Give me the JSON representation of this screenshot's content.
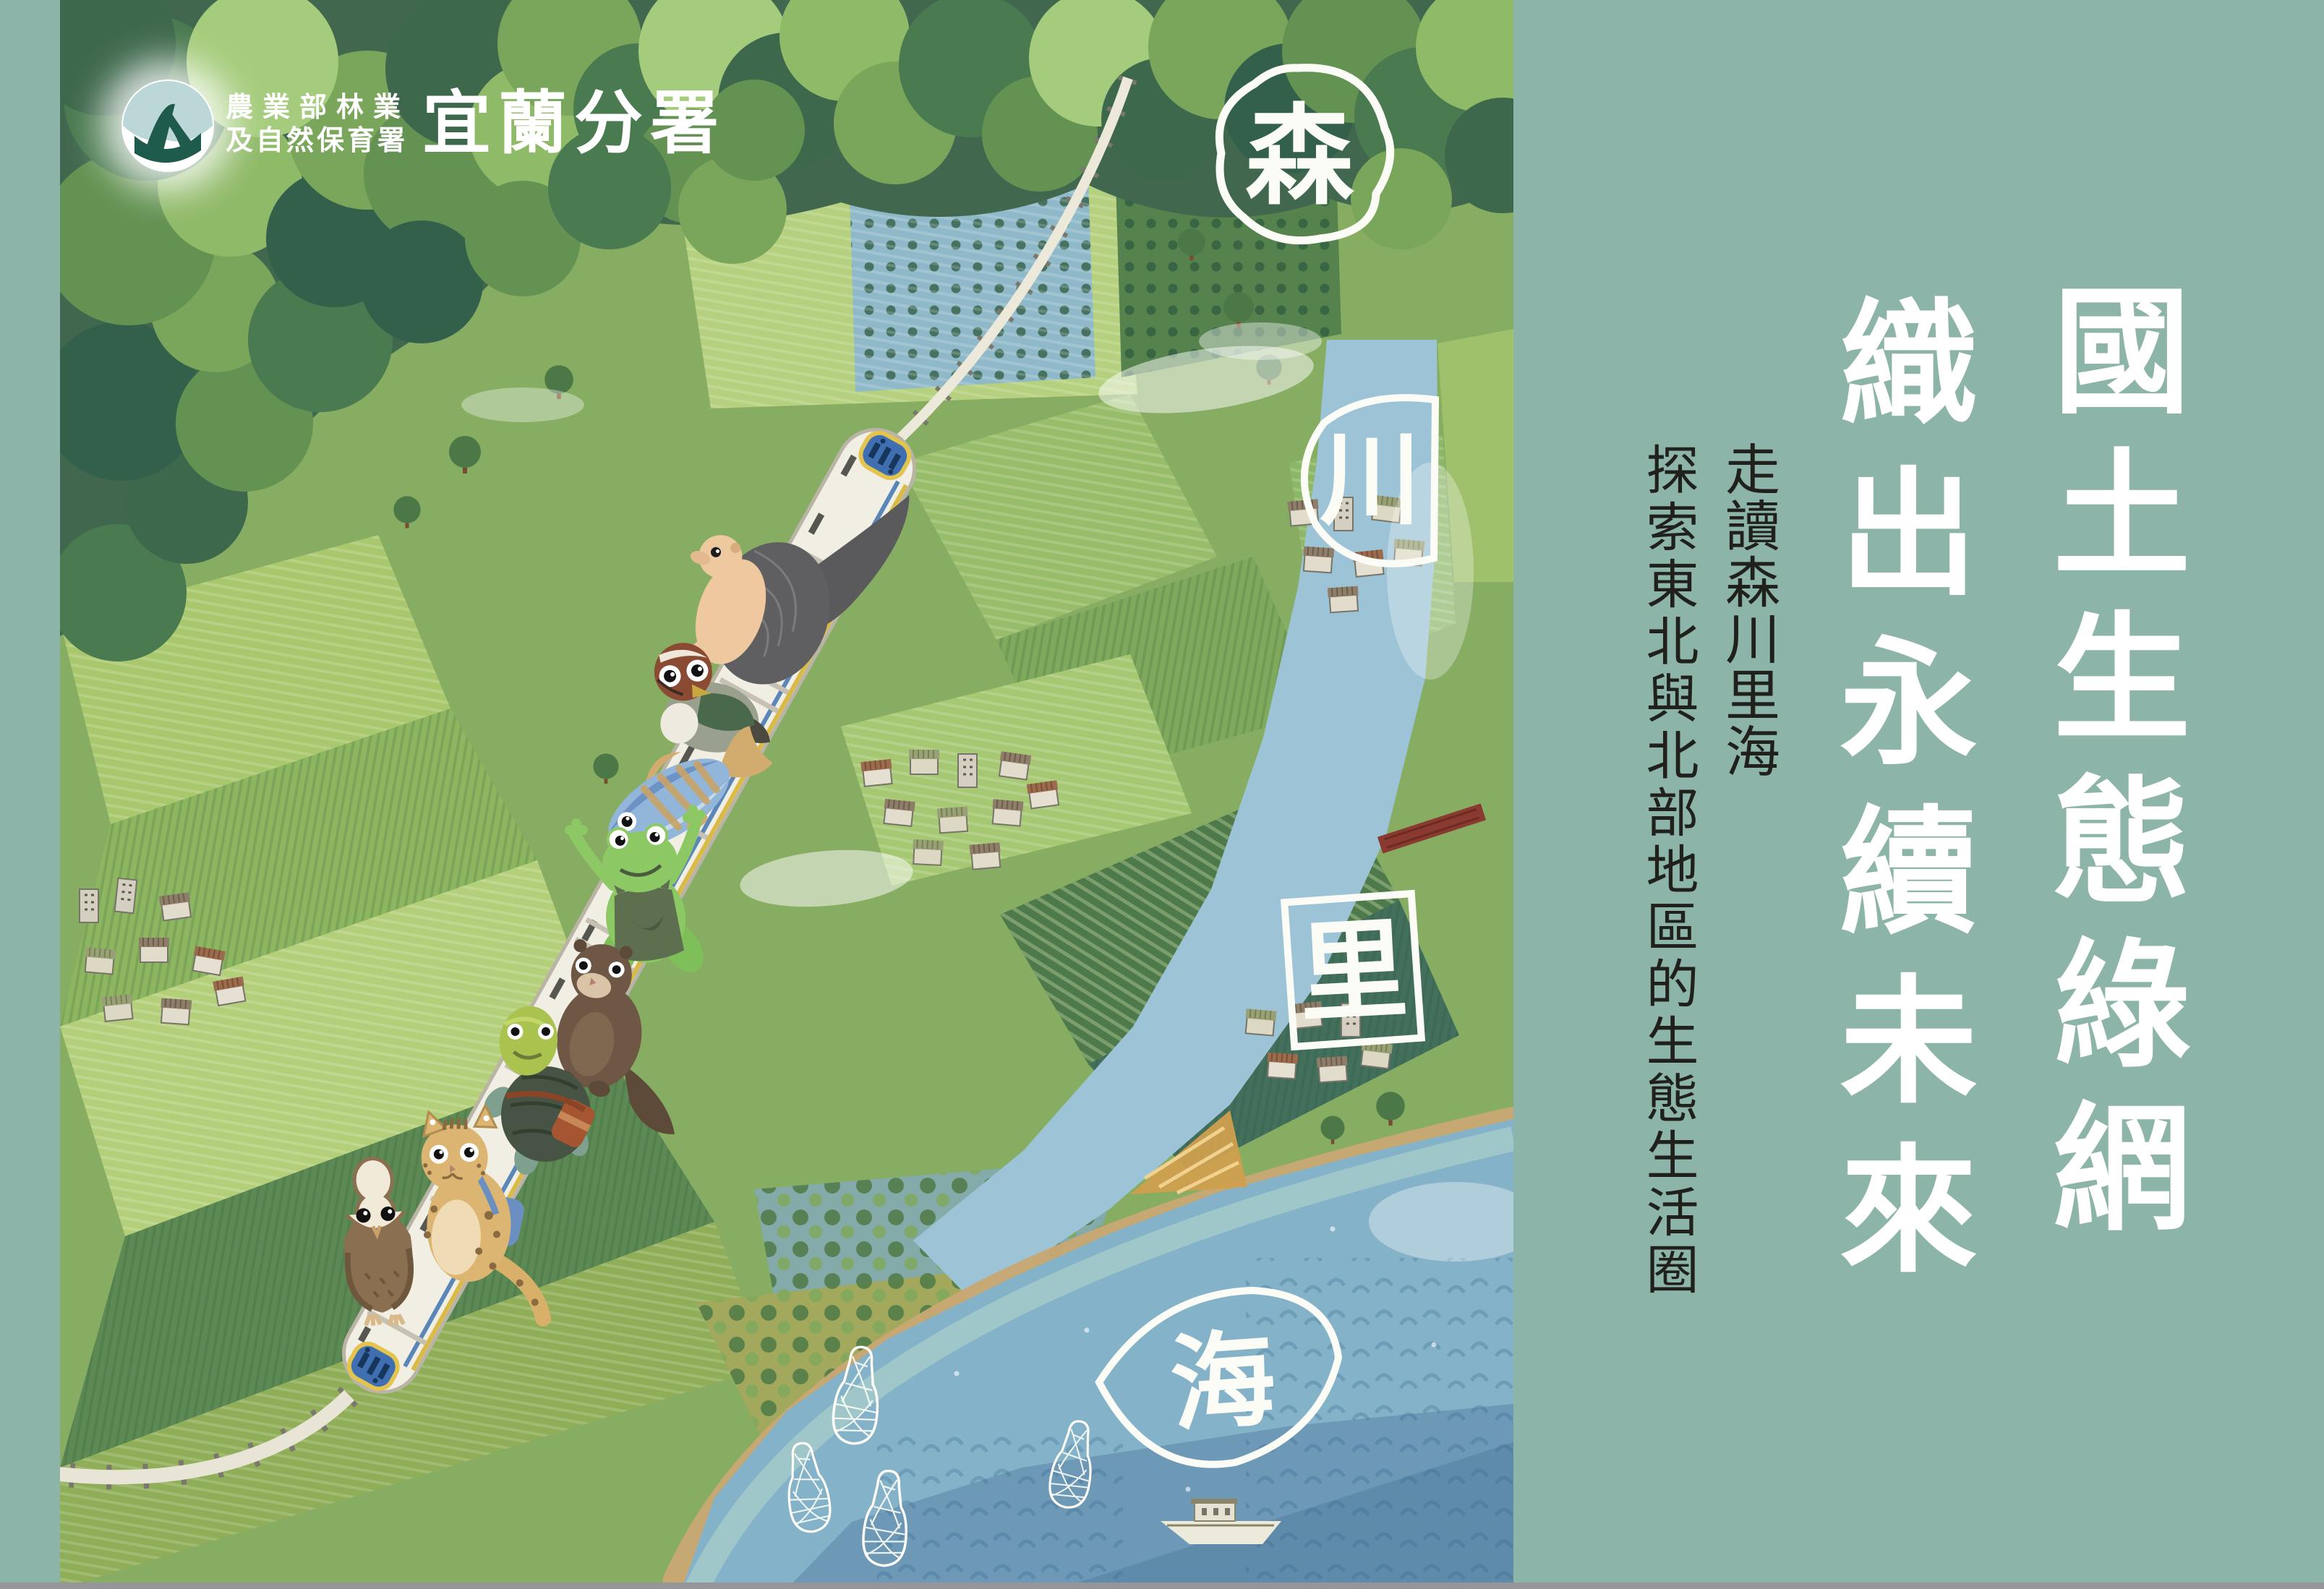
{
  "poster": {
    "background_color": "#8db4a8",
    "bottom_edge_color": "#95959a",
    "title_color": "#ffffff",
    "subtitle_color": "#20211d"
  },
  "logo": {
    "org_line1": "農業部林業",
    "org_line2": "及自然保育署",
    "branch": "宜蘭分署"
  },
  "title": {
    "line1": "國土生態綠網",
    "line2": "織出永續未來"
  },
  "subtitle": {
    "line1": "走讀森川里海",
    "line2": "探索東北與北部地區的生態生活圈"
  },
  "map_labels": {
    "forest": "森",
    "river": "川",
    "village": "里",
    "sea": "海"
  },
  "scene": {
    "animals": [
      "pangolin",
      "mandarin-duck",
      "fish",
      "tree-frog",
      "otter",
      "box-turtle",
      "leopard-cat",
      "barn-owl"
    ],
    "features": [
      "forest-canopy",
      "farm-fields",
      "fish-pond-grid",
      "river",
      "sea",
      "railway",
      "white-train",
      "villages",
      "fish-traps",
      "fishing-boat",
      "red-bridge",
      "clouds"
    ]
  }
}
